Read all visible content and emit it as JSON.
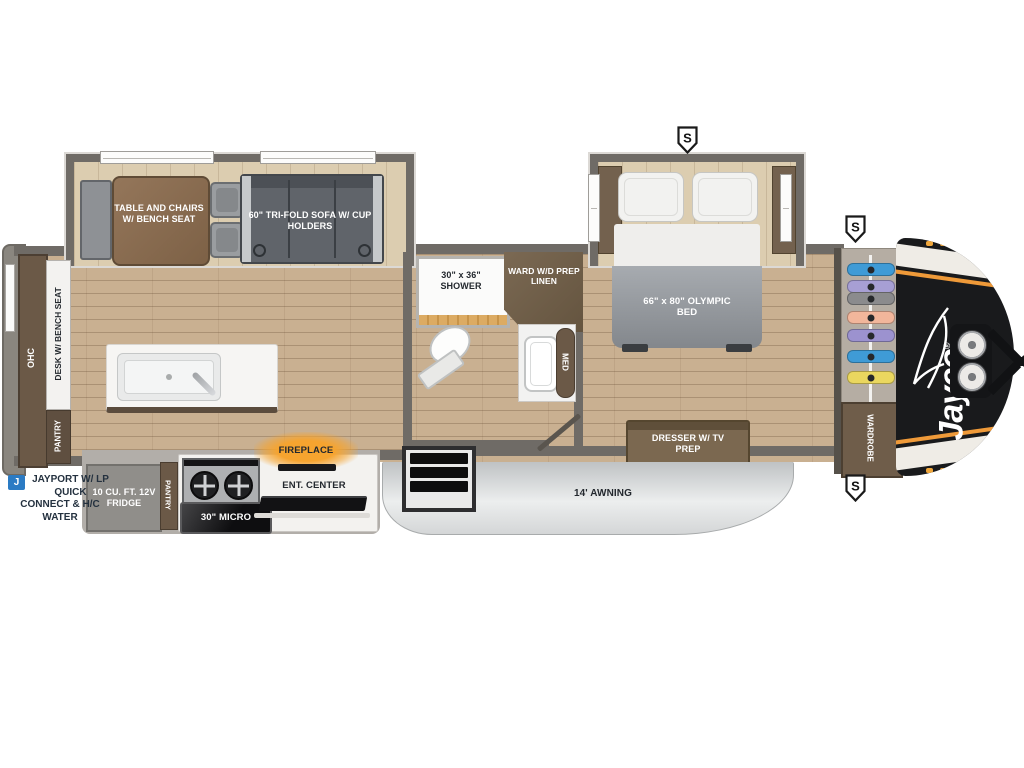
{
  "plan": {
    "brand": "Jayco",
    "brand_reg": "®",
    "speaker_marker": "S",
    "living": {
      "dinette": "TABLE AND CHAIRS W/ BENCH SEAT",
      "sofa": "60\" TRI-FOLD SOFA W/ CUP HOLDERS",
      "ohc": "OHC",
      "desk": "DESK W/ BENCH SEAT",
      "pantry_rear": "PANTRY"
    },
    "kitchen": {
      "fridge": "10 CU. FT. 12V FRIDGE",
      "pantry": "PANTRY",
      "micro": "30\" MICRO",
      "ent_center": "ENT. CENTER",
      "fireplace": "FIREPLACE"
    },
    "bath": {
      "shower": "30\" x 36\" SHOWER",
      "ward": "WARD W/D PREP LINEN",
      "med": "MED"
    },
    "bedroom": {
      "bed": "66\" x 80\" OLYMPIC BED",
      "dresser": "DRESSER W/ TV PREP",
      "wardrobe": "WARDROBE"
    },
    "exterior": {
      "awning": "14' AWNING",
      "jayport_badge": "J",
      "jayport": "JAYPORT W/ LP QUICK CONNECT & H/C WATER"
    },
    "wardrobe_hangers": [
      "#3f9bd6",
      "#a79fd4",
      "#8b8b8d",
      "#f2b69b",
      "#9c92cf",
      "#3f9bd6",
      "#ead75f"
    ],
    "palette": {
      "wall": "#6f6b66",
      "floor": "#c9b091",
      "cabinet": "#6f5d49",
      "accent_orange": "#ef9a39",
      "badge_blue": "#2b7bc4",
      "cap_black": "#191a1c"
    }
  }
}
